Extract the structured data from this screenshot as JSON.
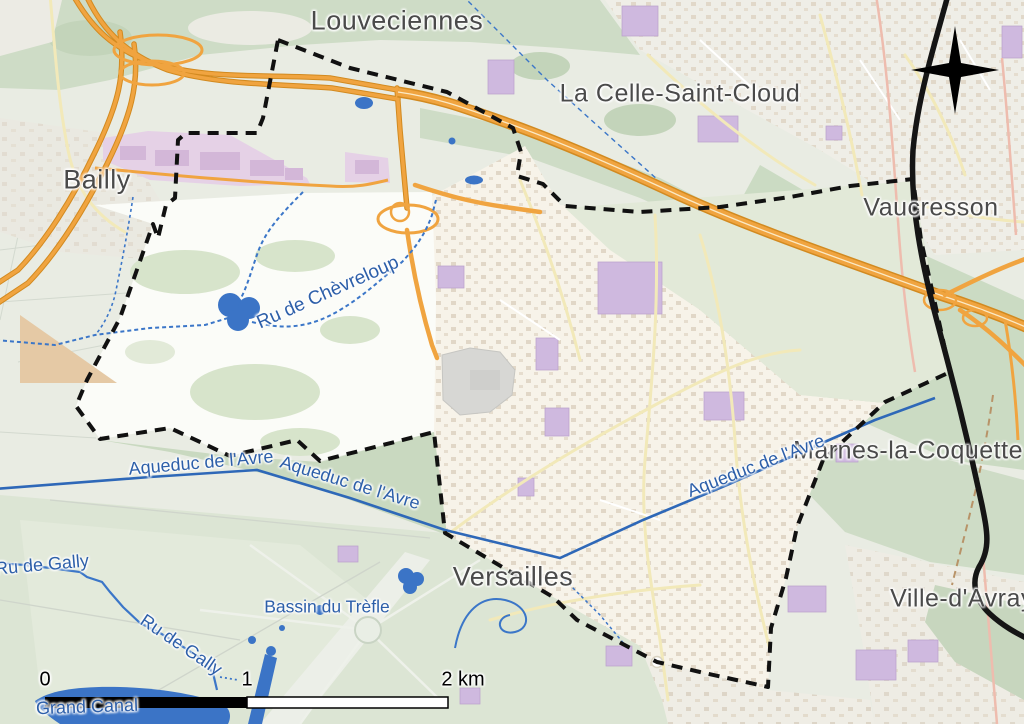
{
  "map": {
    "place_labels": {
      "louveciennes": "Louveciennes",
      "la_celle_saint_cloud": "La Celle-Saint-Cloud",
      "bailly": "Bailly",
      "vaucresson": "Vaucresson",
      "marnes_la_coquette": "Marnes-la-Coquette",
      "ville_d_avray": "Ville-d'Avray",
      "versailles": "Versailles"
    },
    "water_labels": {
      "ru_de_chevreloup": "Ru de Chèvreloup",
      "aqueduc_de_l_avre": "Aqueduc de l'Avre",
      "ru_de_gally": "Ru de Gally",
      "bassin_du_trefle": "Bassin du Trèfle",
      "grand_canal": "Grand Canal"
    },
    "scale_bar": {
      "tick_0": "0",
      "tick_1": "1",
      "tick_2": "2 km"
    },
    "icons": {
      "compass": "north-compass-rose"
    },
    "colors": {
      "motorway": "#f0a440",
      "motorway_casing": "#d28a20",
      "water": "#3b74c6",
      "water_label": "#2d5fa9",
      "place_label": "#4a4a4a",
      "boundary": "#111111",
      "forest": "#cedcc6",
      "urban": "#f2efe7",
      "institutional_purple": "#cfb9df",
      "pink_zone": "#e5d1e6",
      "scale_black": "#000000"
    }
  }
}
